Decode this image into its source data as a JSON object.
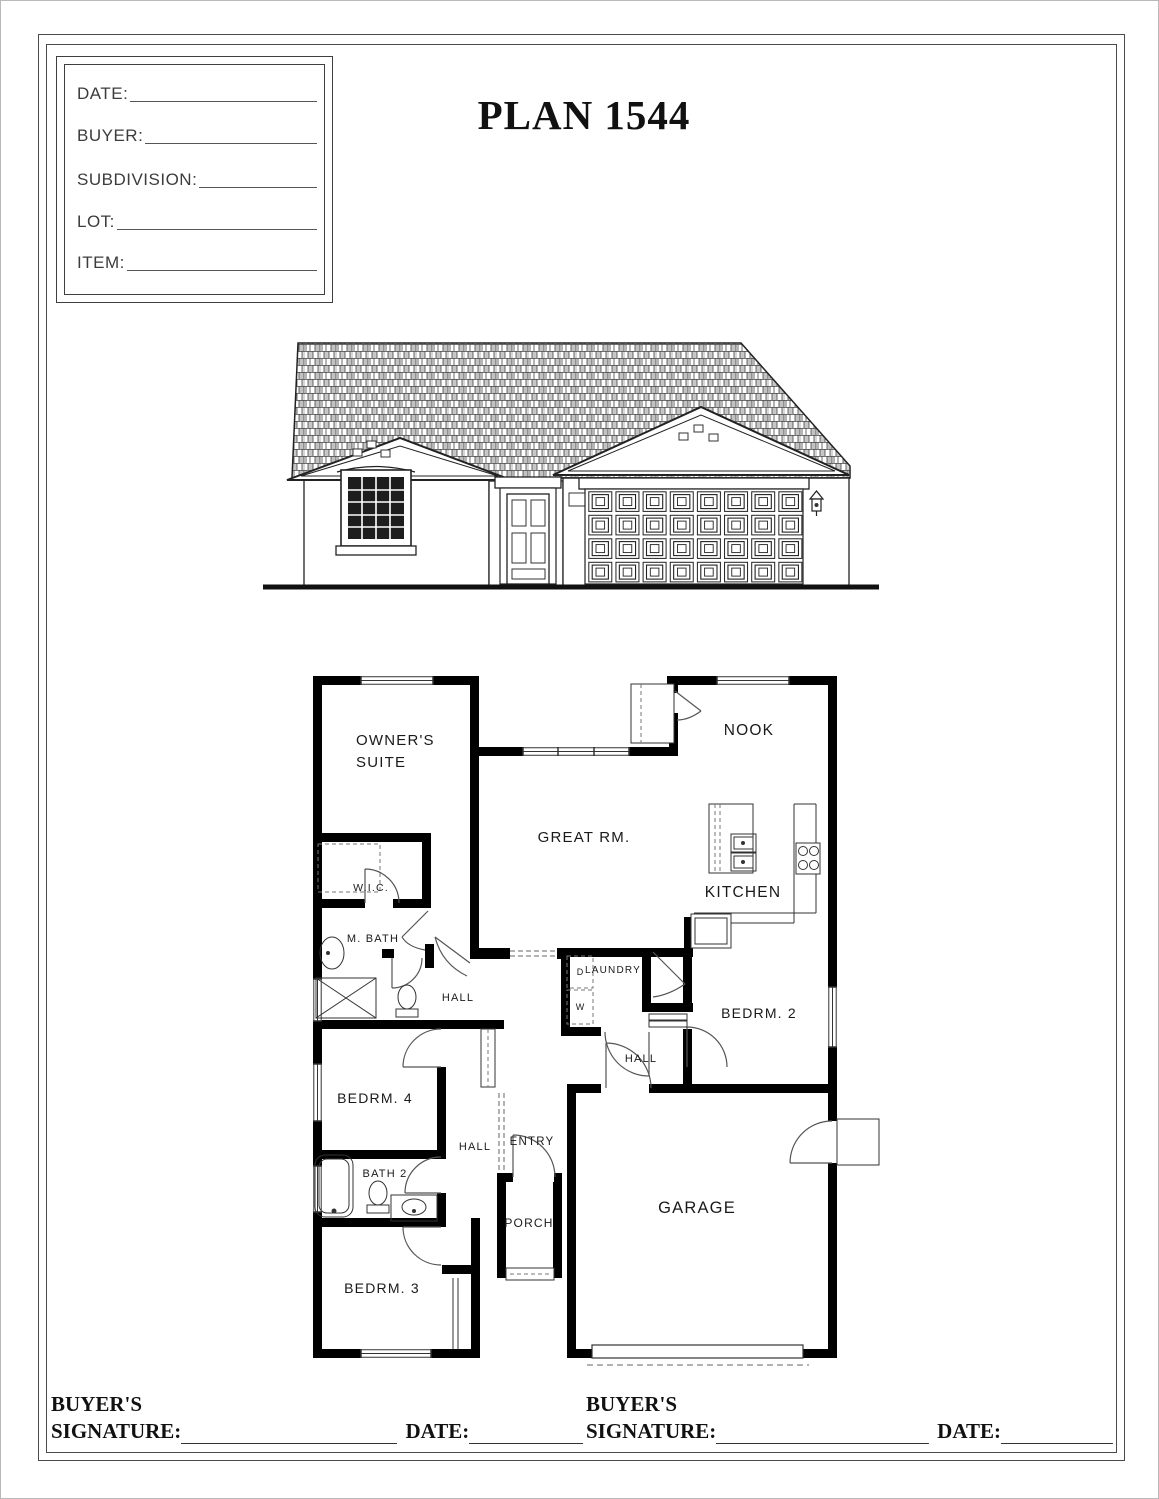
{
  "document": {
    "title": "PLAN 1544"
  },
  "title_block": {
    "fields": [
      {
        "label": "DATE:"
      },
      {
        "label": "BUYER:"
      },
      {
        "label": "SUBDIVISION:"
      },
      {
        "label": "LOT:"
      },
      {
        "label": "ITEM:"
      }
    ]
  },
  "floor_plan": {
    "rooms": {
      "owner_suite_line1": "OWNER'S",
      "owner_suite_line2": "SUITE",
      "great_room": "GREAT RM.",
      "nook": "NOOK",
      "kitchen": "KITCHEN",
      "wic": "W.I.C.",
      "master_bath": "M. BATH",
      "hall_upper": "HALL",
      "hall_mid": "HALL",
      "hall_lower": "HALL",
      "laundry": "LAUNDRY",
      "bedroom2": "BEDRM. 2",
      "bedroom4": "BEDRM. 4",
      "entry": "ENTRY",
      "bath2": "BATH 2",
      "porch": "PORCH",
      "bedroom3": "BEDRM. 3",
      "garage": "GARAGE"
    },
    "appliances": {
      "dryer": "D",
      "washer": "W"
    }
  },
  "signature_block": {
    "left": {
      "line1": "BUYER'S",
      "signature_label": "SIGNATURE:",
      "date_label": "DATE:"
    },
    "right": {
      "line1": "BUYER'S",
      "signature_label": "SIGNATURE:",
      "date_label": "DATE:"
    }
  },
  "colors": {
    "wall": "#000000",
    "ink": "#1a1a1a",
    "paper": "#ffffff"
  }
}
